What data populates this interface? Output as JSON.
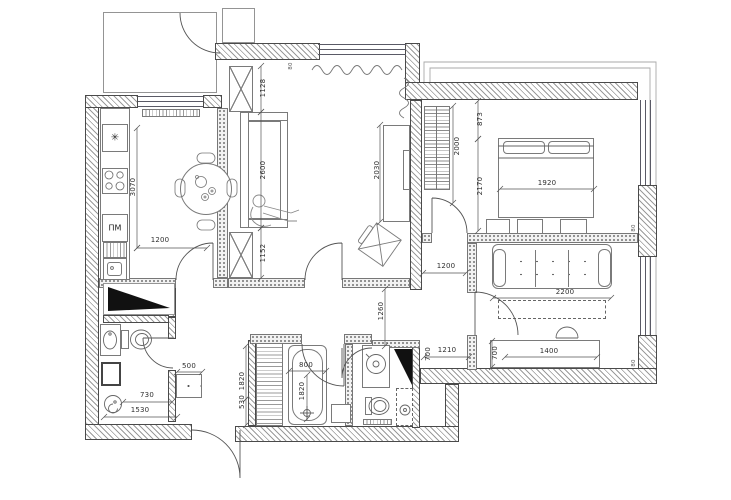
{
  "labels": {
    "dishwasher": "ПМ"
  },
  "icons": {
    "fridge": "✳"
  },
  "colors": {
    "wall_outline": "#4a4a4a",
    "hatch": "#9b9b9b",
    "dimension_text": "#2f2f2f",
    "fill_black": "#111111"
  },
  "dims": [
    "3070",
    "1200",
    "1128",
    "2600",
    "1152",
    "80",
    "2030",
    "2000",
    "873",
    "2170",
    "1920",
    "1200",
    "2200",
    "1260",
    "1210",
    "700",
    "700",
    "1400",
    "500",
    "730",
    "1530",
    "800",
    "1820",
    "1820",
    "530",
    "80",
    "80"
  ]
}
